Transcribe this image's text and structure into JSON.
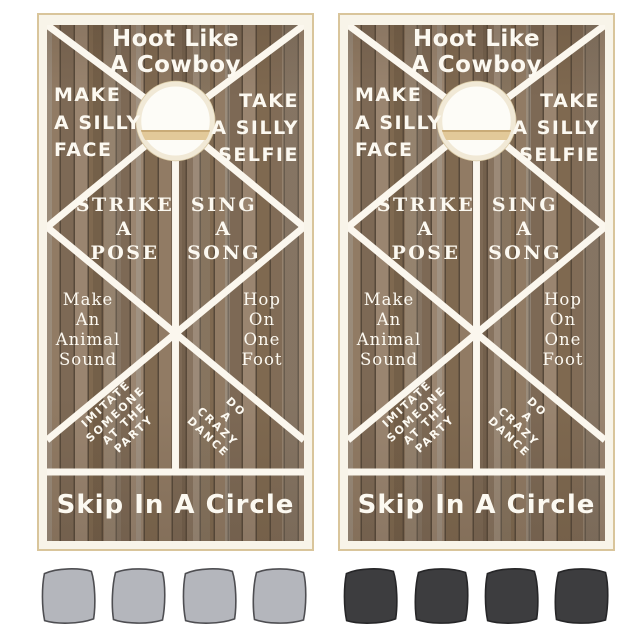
{
  "product": {
    "name": "Hoot Like A Cowboy cornhole board set",
    "boards": 2
  },
  "board": {
    "top_title": [
      "Hoot Like",
      "A Cowboy"
    ],
    "upper_left": [
      "MAKE",
      "A SILLY",
      "FACE"
    ],
    "upper_right": [
      "TAKE",
      "A SILLY",
      "SELFIE"
    ],
    "mid_left": [
      "STRIKE",
      "A",
      "POSE"
    ],
    "mid_right": [
      "SING",
      "A",
      "SONG"
    ],
    "lower_left": [
      "Make",
      "An",
      "Animal",
      "Sound"
    ],
    "lower_right": [
      "Hop",
      "On",
      "One",
      "Foot"
    ],
    "diag_left": [
      "IMITATE",
      "SOMEONE",
      "AT THE",
      "PARTY"
    ],
    "diag_right": [
      "DO",
      "A",
      "CRAZY",
      "DANCE"
    ],
    "bottom_title": "Skip In A Circle"
  },
  "bags": {
    "left_count": 4,
    "right_count": 4
  },
  "colors": {
    "line_white": "#fbf7ee",
    "wood_base": "#87725d",
    "frame_tan": "#d9c59b",
    "hole_fill": "#fdfcf7",
    "hole_strip": "#e2c999",
    "bag_left_fill": "#b4b6bc",
    "bag_left_stroke": "#4e4e52",
    "bag_right_fill": "#3d3d3f",
    "bag_right_stroke": "#262628"
  }
}
